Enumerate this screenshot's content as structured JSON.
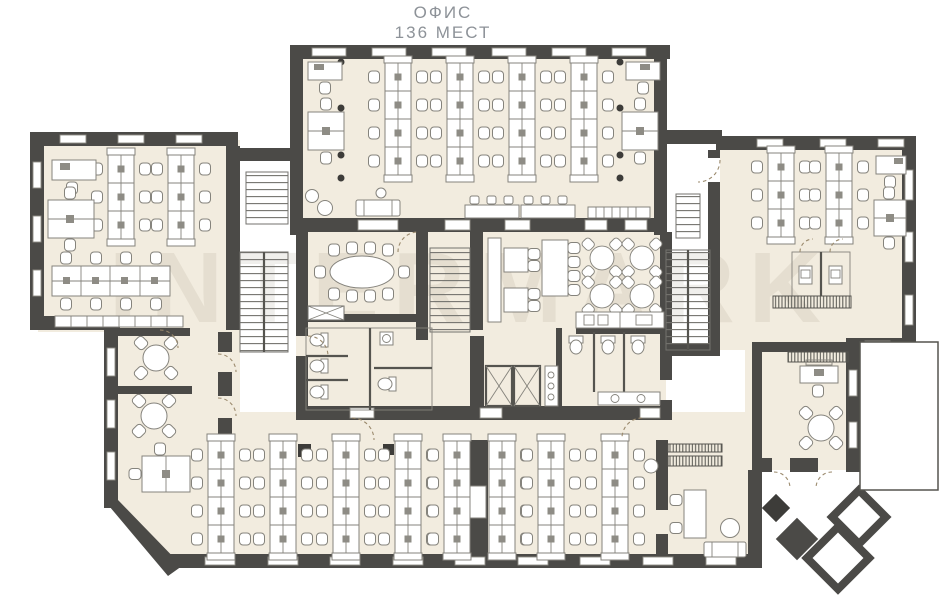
{
  "title": {
    "line1": "ОФИС",
    "line2": "136 МЕСТ"
  },
  "watermark": {
    "text": "INTERMARK"
  },
  "colors": {
    "paper": "#ffffff",
    "floor": "#f2ecdf",
    "wall": "#4b4a47",
    "line": "#85837c",
    "line2": "#8f8d86",
    "cpu": "#8e8c85",
    "door": "#9b8a6d",
    "title": "#8d9298",
    "watermark": "#8d8167"
  },
  "plan": {
    "type": "office-floor-plan",
    "seats_label": "136 МЕСТ",
    "zones": [
      "top-open-office",
      "left-wing-office",
      "right-wing-office",
      "bottom-open-office",
      "meeting-room",
      "cafeteria",
      "kitchen",
      "wc-left",
      "wc-right",
      "elevators",
      "stair-left",
      "stair-center",
      "stair-right",
      "reception-lounge",
      "entrance-stair"
    ]
  }
}
